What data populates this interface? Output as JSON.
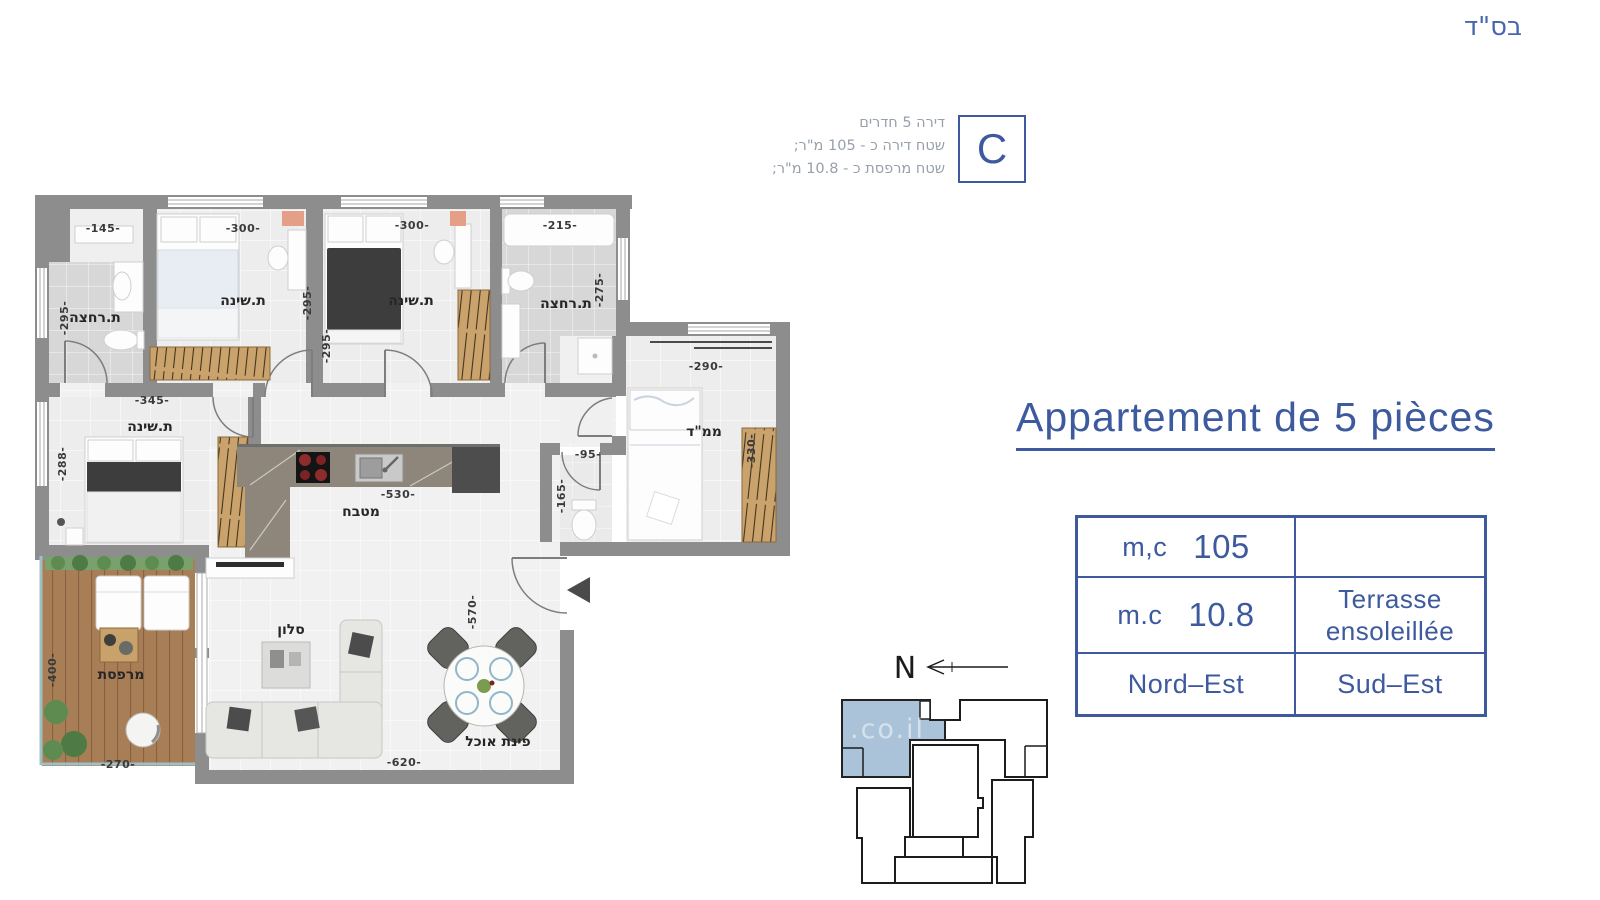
{
  "header": {
    "bsd": "בס\"ד"
  },
  "unit_info": {
    "line1": "דירה 5 חדרים",
    "line2": "שטח דירה כ - 105 מ\"ר;",
    "line3": "שטח מרפסת כ - 10.8 מ\"ר;",
    "letter": "C"
  },
  "title": "Appartement de 5 pièces",
  "spec_table": {
    "r1_label": "m,c",
    "r1_value": "105",
    "r1_right": "",
    "r2_label": "m.c",
    "r2_value": "10.8",
    "r2_right_line1": "Terrasse",
    "r2_right_line2": "ensoleillée",
    "r3_left": "Nord–Est",
    "r3_right": "Sud–Est"
  },
  "compass": {
    "north": "N"
  },
  "watermark": ".co.il",
  "colors": {
    "accent": "#3d5a9e",
    "bsd_blue": "#4767ae",
    "info_gray": "#97a0ab",
    "wall_gray": "#8d8d8d",
    "keyplan_unit_fill": "#abc3d8"
  },
  "plan": {
    "rooms": [
      "ת.רחצה",
      "ת.שינה",
      "ת.שינה",
      "ת.רחצה",
      "ת.שינה",
      "ממ\"ד",
      "מטבח",
      "סלון",
      "פינת אוכל",
      "מרפסת"
    ],
    "dims": [
      "-145-",
      "-300-",
      "-300-",
      "-215-",
      "-295-",
      "-295-",
      "-295-",
      "-275-",
      "-345-",
      "-288-",
      "-290-",
      "-330-",
      "-95-",
      "-165-",
      "-530-",
      "-570-",
      "-400-",
      "-270-",
      "-620-"
    ]
  }
}
